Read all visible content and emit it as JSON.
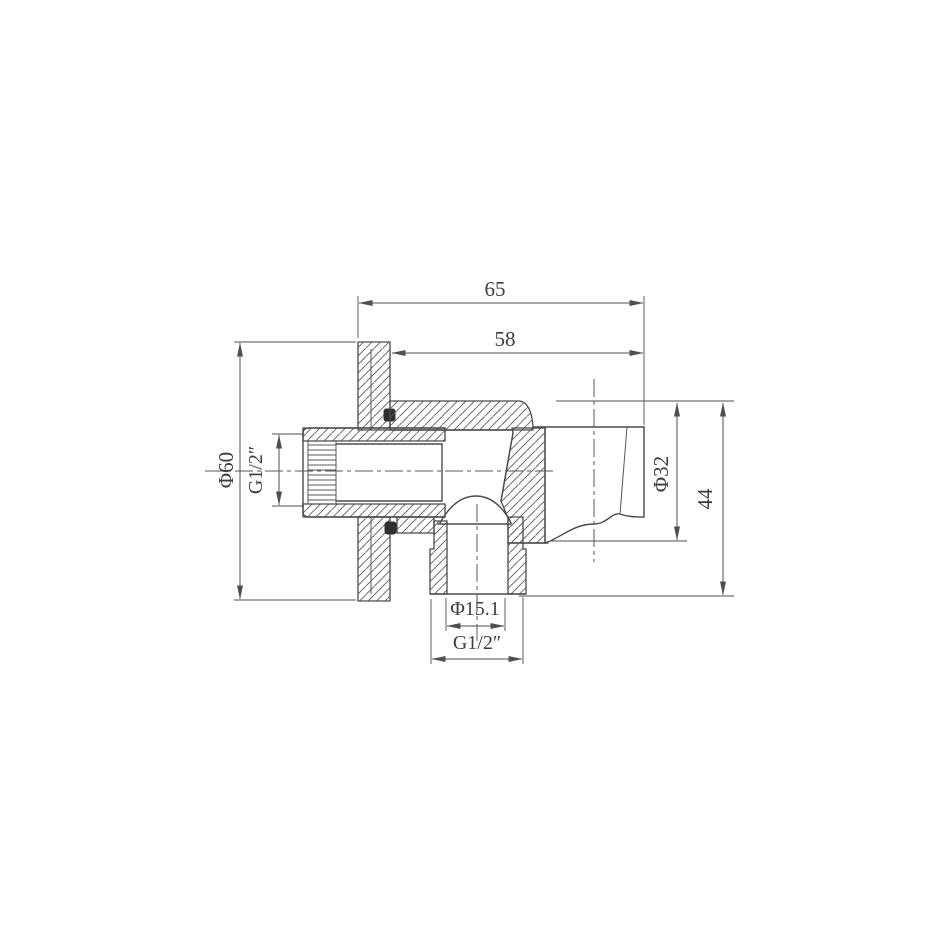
{
  "drawing": {
    "title": "shower-outlet-elbow-with-holder-section-view",
    "dimensions": {
      "overall_width": "65",
      "body_depth": "58",
      "flange_diameter": "Φ60",
      "inlet_thread": "G1/2″",
      "holder_diameter": "Φ32",
      "holder_height": "44",
      "outlet_bore_diameter": "Φ15.1",
      "outlet_thread": "G1/2″"
    },
    "colors": {
      "background": "#ffffff",
      "line": "#4b4b4d",
      "text": "#3d3d3f"
    }
  }
}
